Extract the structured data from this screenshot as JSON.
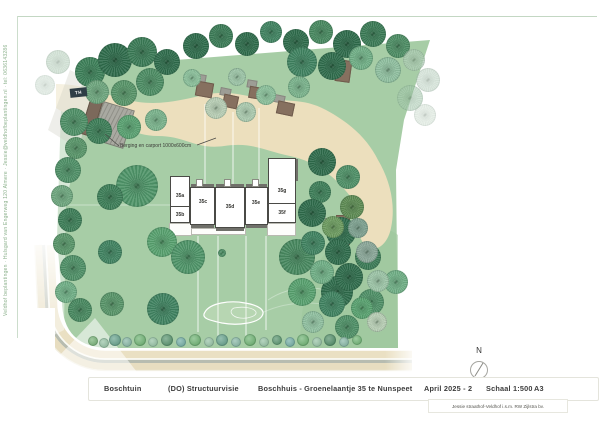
{
  "frame": {
    "sidebar_vertical_text": "Veldhof beplantingen · Hulsgard van Engerweg 120 Almere · Jessie@veldhofbeplantingen.nl · tel: 0636143286"
  },
  "titleblock": {
    "project": "Boschtuin",
    "phase": "(DO) Structuurvisie",
    "subject": "Boschhuis - Groenelaantje 35 te Nunspeet",
    "date": "April 2025 - 2",
    "scale": "Schaal 1:500",
    "format": "A3",
    "credit": "Jessie straathof-Veldhof i.s.m. RW Zijlstra bv.",
    "north_label": "N"
  },
  "plan": {
    "annotation_carport": "Berging en carport 1000x600cm",
    "sign_label": "TH",
    "units": [
      {
        "label": "35a"
      },
      {
        "label": "35b"
      },
      {
        "label": "35c"
      },
      {
        "label": "35d"
      },
      {
        "label": "35e"
      },
      {
        "label": "35f"
      },
      {
        "label": "35g"
      }
    ],
    "colors": {
      "site_green": "#a7cda6",
      "lawn_wash": "#9cc79b",
      "sand_path": "#ecdfbd",
      "road_beige": "#eae0c3",
      "road_gray": "#b7bcb0",
      "building_fill": "#ffffff",
      "building_line": "#4a4a46",
      "shed_brown": "#86705f",
      "roof_gray": "#9d9d95",
      "frame_green": "#c3d7c3",
      "tree_dark": "#2e6b4b",
      "tree_light": "#8fbf9f"
    },
    "trees": [
      [
        90,
        72,
        15,
        "#3c7f58"
      ],
      [
        115,
        60,
        17,
        "#2e6b4b"
      ],
      [
        142,
        52,
        15,
        "#3a7a55"
      ],
      [
        167,
        62,
        13,
        "#2e6b4b"
      ],
      [
        150,
        82,
        14,
        "#4c8c63"
      ],
      [
        124,
        93,
        13,
        "#579468"
      ],
      [
        97,
        92,
        12,
        "#6da57d"
      ],
      [
        74,
        122,
        14,
        "#4e8f66"
      ],
      [
        99,
        131,
        13,
        "#3c7d57"
      ],
      [
        129,
        127,
        12,
        "#58a070"
      ],
      [
        156,
        120,
        11,
        "#79b28b"
      ],
      [
        76,
        148,
        11,
        "#579468"
      ],
      [
        196,
        46,
        13,
        "#2e6b4b"
      ],
      [
        221,
        36,
        12,
        "#3a7a55"
      ],
      [
        247,
        44,
        12,
        "#2e6b4b"
      ],
      [
        271,
        32,
        11,
        "#3f8260"
      ],
      [
        296,
        42,
        13,
        "#2e6b4b"
      ],
      [
        321,
        32,
        12,
        "#47885f"
      ],
      [
        347,
        44,
        14,
        "#2e6b4b"
      ],
      [
        373,
        34,
        13,
        "#3a7a55"
      ],
      [
        398,
        46,
        12,
        "#4c8c63"
      ],
      [
        302,
        62,
        15,
        "#3f8260"
      ],
      [
        332,
        66,
        14,
        "#2e6b4b"
      ],
      [
        361,
        58,
        12,
        "#6fae85"
      ],
      [
        388,
        70,
        13,
        "#8fbf9f"
      ],
      [
        414,
        60,
        11,
        "#a9c8b0",
        0.7
      ],
      [
        428,
        80,
        12,
        "#b9d2c0",
        0.55
      ],
      [
        410,
        98,
        13,
        "#9cc4a6",
        0.55
      ],
      [
        425,
        115,
        11,
        "#cfe0d2",
        0.5
      ],
      [
        192,
        78,
        9,
        "#8abf9a"
      ],
      [
        237,
        77,
        9,
        "#9cc4a6"
      ],
      [
        266,
        95,
        10,
        "#8abf9a"
      ],
      [
        216,
        108,
        11,
        "#b7cdb4"
      ],
      [
        246,
        112,
        10,
        "#aac9ae"
      ],
      [
        299,
        87,
        11,
        "#79b28b"
      ],
      [
        68,
        170,
        13,
        "#4e8f66"
      ],
      [
        62,
        196,
        11,
        "#6da57d"
      ],
      [
        70,
        220,
        12,
        "#3c7d57"
      ],
      [
        64,
        244,
        11,
        "#579468"
      ],
      [
        73,
        268,
        13,
        "#4e8f66"
      ],
      [
        66,
        292,
        11,
        "#6fae85"
      ],
      [
        80,
        310,
        12,
        "#47885f"
      ],
      [
        137,
        186,
        21,
        "#4e9468"
      ],
      [
        110,
        197,
        13,
        "#3c7d57"
      ],
      [
        162,
        242,
        15,
        "#57a06e"
      ],
      [
        110,
        252,
        12,
        "#3f8260"
      ],
      [
        188,
        257,
        17,
        "#4e9468"
      ],
      [
        297,
        257,
        18,
        "#47885f"
      ],
      [
        341,
        232,
        15,
        "#2e6b4b"
      ],
      [
        368,
        257,
        13,
        "#3a7a55"
      ],
      [
        302,
        292,
        14,
        "#57a06e"
      ],
      [
        337,
        292,
        16,
        "#2e6b4b"
      ],
      [
        371,
        302,
        13,
        "#4e8f66"
      ],
      [
        396,
        282,
        12,
        "#6fae85"
      ],
      [
        163,
        309,
        16,
        "#3f8260"
      ],
      [
        112,
        304,
        12,
        "#579468"
      ],
      [
        322,
        162,
        14,
        "#2e6b4b"
      ],
      [
        348,
        177,
        12,
        "#4e8f66"
      ],
      [
        320,
        192,
        11,
        "#3c7d57"
      ],
      [
        352,
        207,
        12,
        "#5c8a52"
      ],
      [
        312,
        213,
        14,
        "#2e6b4b"
      ],
      [
        333,
        227,
        11,
        "#6b9a5e"
      ],
      [
        358,
        228,
        10,
        "#7da08f"
      ],
      [
        313,
        243,
        12,
        "#3f8260"
      ],
      [
        338,
        252,
        13,
        "#2e6b4b"
      ],
      [
        367,
        252,
        11,
        "#8aa698"
      ],
      [
        322,
        272,
        12,
        "#6fae85"
      ],
      [
        349,
        277,
        14,
        "#2e6b4b"
      ],
      [
        378,
        281,
        11,
        "#9cc4a6"
      ],
      [
        332,
        304,
        13,
        "#3f8260"
      ],
      [
        362,
        308,
        11,
        "#57a06e"
      ],
      [
        313,
        322,
        11,
        "#8fbf9f"
      ],
      [
        347,
        327,
        12,
        "#4e8f66"
      ],
      [
        377,
        322,
        10,
        "#b7cdb4"
      ],
      [
        222,
        253,
        4,
        "#4e8f66"
      ],
      [
        58,
        62,
        12,
        "#a9c8b0",
        0.5
      ],
      [
        45,
        85,
        10,
        "#b9d2c0",
        0.4
      ]
    ],
    "shrubs": [
      [
        93,
        341,
        5,
        "#6fae6f"
      ],
      [
        104,
        343,
        5,
        "#8fbf9f"
      ],
      [
        115,
        340,
        6,
        "#5d9d86"
      ],
      [
        127,
        342,
        5,
        "#7fb3a0"
      ],
      [
        140,
        340,
        6,
        "#66b06b"
      ],
      [
        153,
        342,
        5,
        "#8fbf9f"
      ],
      [
        167,
        340,
        6,
        "#4e8f66"
      ],
      [
        181,
        342,
        5,
        "#6aa9a0"
      ],
      [
        195,
        340,
        6,
        "#66b06b"
      ],
      [
        209,
        342,
        5,
        "#8fbf9f"
      ],
      [
        222,
        340,
        6,
        "#5d9d86"
      ],
      [
        236,
        342,
        5,
        "#7fb3a0"
      ],
      [
        250,
        340,
        6,
        "#66b06b"
      ],
      [
        264,
        342,
        5,
        "#8fbf9f"
      ],
      [
        277,
        340,
        5,
        "#4e8f66"
      ],
      [
        290,
        342,
        5,
        "#6aa9a0"
      ],
      [
        303,
        340,
        6,
        "#66b06b"
      ],
      [
        317,
        342,
        5,
        "#8fbf9f"
      ],
      [
        330,
        340,
        6,
        "#47885f"
      ],
      [
        344,
        342,
        5,
        "#7fb3a0"
      ],
      [
        357,
        340,
        5,
        "#66b06b"
      ]
    ]
  }
}
